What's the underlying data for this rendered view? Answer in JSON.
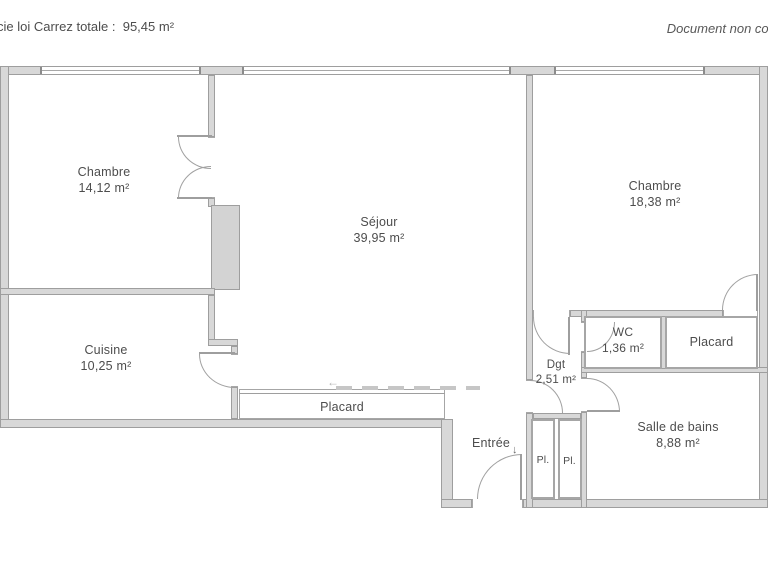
{
  "header": {
    "left_text": "cie loi Carrez totale :  95,45 m²",
    "right_text": "Document non cor"
  },
  "rooms": [
    {
      "name": "Chambre",
      "area": "14,12 m²"
    },
    {
      "name": "Séjour",
      "area": "39,95 m²"
    },
    {
      "name": "Chambre",
      "area": "18,38 m²"
    },
    {
      "name": "Cuisine",
      "area": "10,25 m²"
    },
    {
      "name": "WC",
      "area": "1,36 m²"
    },
    {
      "name": "Placard",
      "area": ""
    },
    {
      "name": "Dgt",
      "area": "2,51 m²"
    },
    {
      "name": "Placard",
      "area": ""
    },
    {
      "name": "Entrée",
      "area": ""
    },
    {
      "name": "Pl.",
      "area": ""
    },
    {
      "name": "Pl.",
      "area": ""
    },
    {
      "name": "Salle de bains",
      "area": "8,88 m²"
    }
  ],
  "icons": {
    "entry_arrow": "↓",
    "watermark_arrow": "←"
  },
  "colors": {
    "wall_fill": "#d8d8d8",
    "wall_line": "#9e9e9e",
    "text": "#4d4d4d",
    "background": "#ffffff"
  }
}
